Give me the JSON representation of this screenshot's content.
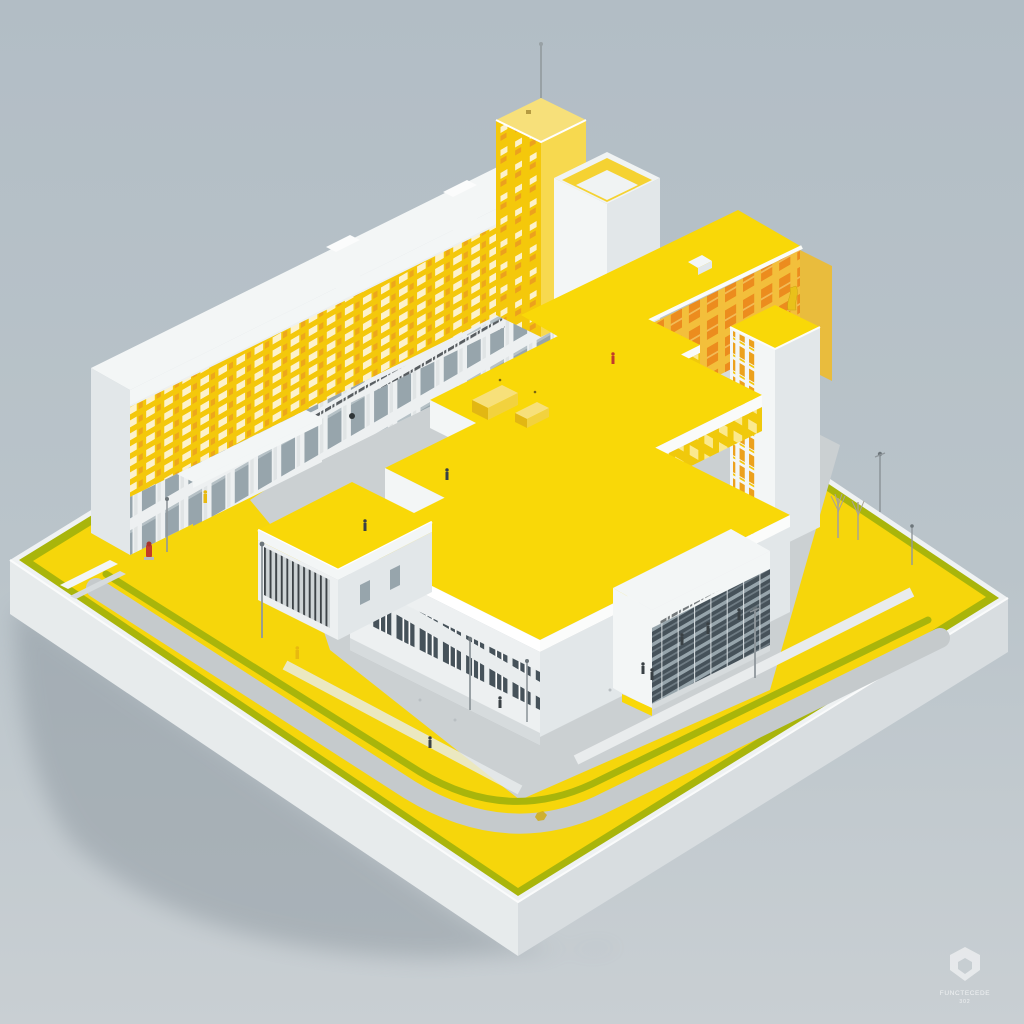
{
  "scene": {
    "alt": "Isometric 3D render of a modernist white-and-yellow civic building complex on a square white plinth: long slab block with yellow window facade, two towers, large stepped yellow-roof hall, orange-windowed wing, glass entrance pavilion, yellow plaza with olive-green strips, gray paths, lamps, trees and tiny pedestrians on a pale blue-gray backdrop"
  },
  "watermark": {
    "brand": "FUNCTECEDE",
    "tagline": "302"
  },
  "palette": {
    "bg_top": "#b2bdc5",
    "bg_bottom": "#c9cfd3",
    "shadow": "#87929a",
    "base_white": "#eff2f3",
    "base_side": "#e7ebec",
    "base_side_dark": "#d8dde0",
    "ground_yellow": "#f6d60b",
    "olive": "#a9b50b",
    "road_gray": "#c5cacc",
    "plaza_gray": "#cbd0d2",
    "walk_white": "#e9eced",
    "building_white": "#f3f6f6",
    "building_face": "#edf0f1",
    "building_shade": "#e2e7e9",
    "building_dark": "#d6dbdd",
    "roof_yellow": "#f9d808",
    "facade_yellow": "#f4c80b",
    "pale_yellow": "#f7e07a",
    "window_lite": "#fdf2cb",
    "amber": "#eca11d",
    "orange_face": "#f3bf3b",
    "orange_window": "#ec8c1e",
    "window_dark": "#46525a",
    "glass": "#97a5ac",
    "sign_dark": "#3c4246",
    "accent_red": "#c23b2b",
    "accent_yellow": "#e8b90f",
    "lamp_gray": "#8f979c",
    "figure_dark": "#3a4145",
    "watermark": "#ffffff"
  }
}
